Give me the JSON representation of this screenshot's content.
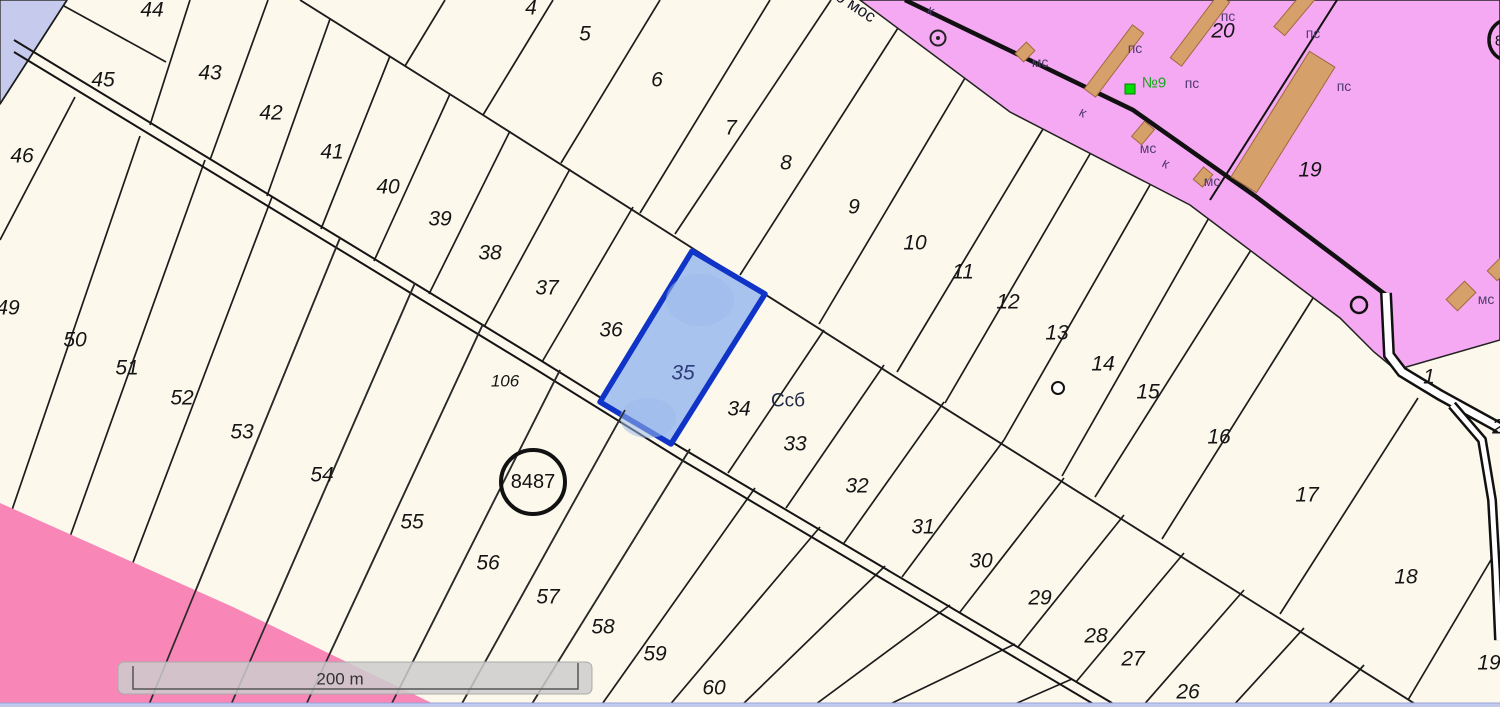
{
  "map": {
    "colors": {
      "background": "#fcf9ec",
      "parcel_line": "#1c1c1c",
      "urban_pink": "#f6a9f3",
      "rose_zone": "#f886b7",
      "water_blue": "#c6cbed",
      "bottom_strip": "#c3c9ee",
      "building_tan": "#d6a06b",
      "building_edge": "#9c6a3c",
      "highlight_fill": "#a9c3ef",
      "highlight_stroke": "#1034c8",
      "scale_bar_fill": "#cdcdcd",
      "green_label": "#17a617"
    },
    "selected_parcel": {
      "number": "35"
    },
    "parcel_labels": [
      {
        "text": "1",
        "x": 1429,
        "y": 377
      },
      {
        "text": "2",
        "x": 1498,
        "y": 427
      },
      {
        "text": "4",
        "x": 531,
        "y": 8
      },
      {
        "text": "5",
        "x": 585,
        "y": 34
      },
      {
        "text": "6",
        "x": 657,
        "y": 80
      },
      {
        "text": "7",
        "x": 731,
        "y": 128
      },
      {
        "text": "8",
        "x": 786,
        "y": 163
      },
      {
        "text": "9",
        "x": 854,
        "y": 207
      },
      {
        "text": "10",
        "x": 915,
        "y": 243
      },
      {
        "text": "11",
        "x": 963,
        "y": 272
      },
      {
        "text": "12",
        "x": 1008,
        "y": 302
      },
      {
        "text": "13",
        "x": 1057,
        "y": 333
      },
      {
        "text": "14",
        "x": 1103,
        "y": 364
      },
      {
        "text": "15",
        "x": 1148,
        "y": 392
      },
      {
        "text": "16",
        "x": 1219,
        "y": 437
      },
      {
        "text": "17",
        "x": 1307,
        "y": 495
      },
      {
        "text": "18",
        "x": 1406,
        "y": 577
      },
      {
        "text": "19",
        "x": 1489,
        "y": 663
      },
      {
        "text": "20",
        "x": 1223,
        "y": 31
      },
      {
        "text": "19",
        "x": 1310,
        "y": 170
      },
      {
        "text": "26",
        "x": 1188,
        "y": 692
      },
      {
        "text": "27",
        "x": 1133,
        "y": 659
      },
      {
        "text": "28",
        "x": 1096,
        "y": 636
      },
      {
        "text": "29",
        "x": 1040,
        "y": 598
      },
      {
        "text": "30",
        "x": 981,
        "y": 561
      },
      {
        "text": "31",
        "x": 923,
        "y": 527
      },
      {
        "text": "32",
        "x": 857,
        "y": 486
      },
      {
        "text": "33",
        "x": 795,
        "y": 444
      },
      {
        "text": "34",
        "x": 739,
        "y": 409
      },
      {
        "text": "35",
        "x": 683,
        "y": 373,
        "color": "#2e3c7a"
      },
      {
        "text": "36",
        "x": 611,
        "y": 330
      },
      {
        "text": "37",
        "x": 547,
        "y": 288
      },
      {
        "text": "38",
        "x": 490,
        "y": 253
      },
      {
        "text": "39",
        "x": 440,
        "y": 219
      },
      {
        "text": "40",
        "x": 388,
        "y": 187
      },
      {
        "text": "41",
        "x": 332,
        "y": 152
      },
      {
        "text": "42",
        "x": 271,
        "y": 113
      },
      {
        "text": "43",
        "x": 210,
        "y": 73
      },
      {
        "text": "44",
        "x": 152,
        "y": 10
      },
      {
        "text": "45",
        "x": 103,
        "y": 80
      },
      {
        "text": "46",
        "x": 22,
        "y": 156
      },
      {
        "text": "49",
        "x": 8,
        "y": 308
      },
      {
        "text": "50",
        "x": 75,
        "y": 340
      },
      {
        "text": "51",
        "x": 127,
        "y": 368
      },
      {
        "text": "52",
        "x": 182,
        "y": 398
      },
      {
        "text": "53",
        "x": 242,
        "y": 432
      },
      {
        "text": "54",
        "x": 322,
        "y": 475
      },
      {
        "text": "55",
        "x": 412,
        "y": 522
      },
      {
        "text": "56",
        "x": 488,
        "y": 563
      },
      {
        "text": "57",
        "x": 548,
        "y": 597
      },
      {
        "text": "58",
        "x": 603,
        "y": 627
      },
      {
        "text": "59",
        "x": 655,
        "y": 654
      },
      {
        "text": "60",
        "x": 714,
        "y": 688
      },
      {
        "text": "106",
        "x": 505,
        "y": 381,
        "size": 17
      }
    ],
    "zone_labels": [
      {
        "text": "пс",
        "x": 1228,
        "y": 16
      },
      {
        "text": "пс",
        "x": 1313,
        "y": 33
      },
      {
        "text": "пс",
        "x": 1135,
        "y": 48
      },
      {
        "text": "пс",
        "x": 1192,
        "y": 83
      },
      {
        "text": "пс",
        "x": 1344,
        "y": 86
      },
      {
        "text": "мс",
        "x": 1040,
        "y": 62
      },
      {
        "text": "мс",
        "x": 1148,
        "y": 148
      },
      {
        "text": "мс",
        "x": 1212,
        "y": 181
      },
      {
        "text": "мс",
        "x": 1486,
        "y": 299
      },
      {
        "text": "к",
        "x": 931,
        "y": 10,
        "rot": 28
      },
      {
        "text": "к",
        "x": 1083,
        "y": 112,
        "rot": 28
      },
      {
        "text": "к",
        "x": 1166,
        "y": 163,
        "rot": 28
      }
    ],
    "green_marker": {
      "text": "№9",
      "x": 1154,
      "y": 83
    },
    "road_name": {
      "text": "во мос",
      "x": 852,
      "y": 4,
      "rot": 33
    },
    "land_code": {
      "text": "Ссб",
      "x": 788,
      "y": 401
    },
    "circled_main": {
      "text": "8487",
      "x": 533,
      "y": 482
    },
    "circled_corner": {
      "text": "8",
      "x": 1499,
      "y": 41
    },
    "scale_bar": {
      "label": "200 m"
    }
  }
}
